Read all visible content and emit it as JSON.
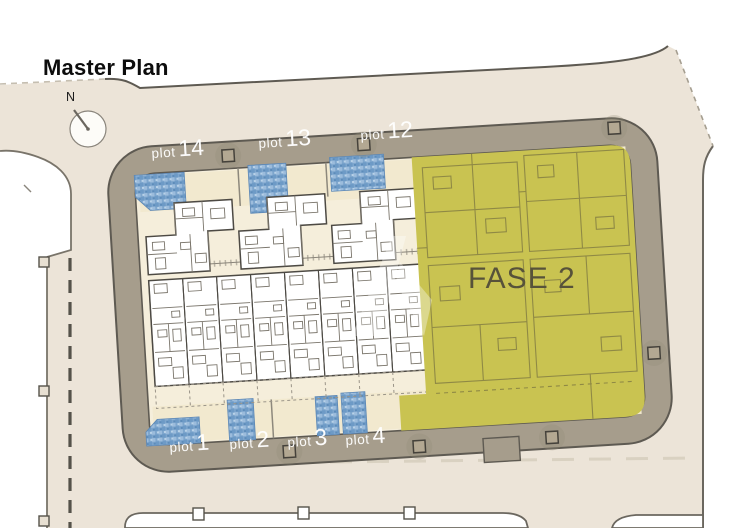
{
  "title": "Master Plan",
  "compass": {
    "label": "N"
  },
  "phase": {
    "label": "FASE 2",
    "color": "#c9c351",
    "text_color": "#57523a"
  },
  "plots": {
    "top": [
      {
        "prefix": "plot",
        "number": "14"
      },
      {
        "prefix": "plot",
        "number": "13"
      },
      {
        "prefix": "plot",
        "number": "12"
      }
    ],
    "bottom": [
      {
        "prefix": "plot",
        "number": "1"
      },
      {
        "prefix": "plot",
        "number": "2"
      },
      {
        "prefix": "plot",
        "number": "3"
      },
      {
        "prefix": "plot",
        "number": "4"
      }
    ]
  },
  "palette": {
    "ground": "#ece4d8",
    "road": "#a69d8c",
    "road_outline": "#5e5a52",
    "phase2_fill": "#c9c351",
    "pool": "#7ea6cd",
    "plan_paper": "#f5eedb"
  }
}
